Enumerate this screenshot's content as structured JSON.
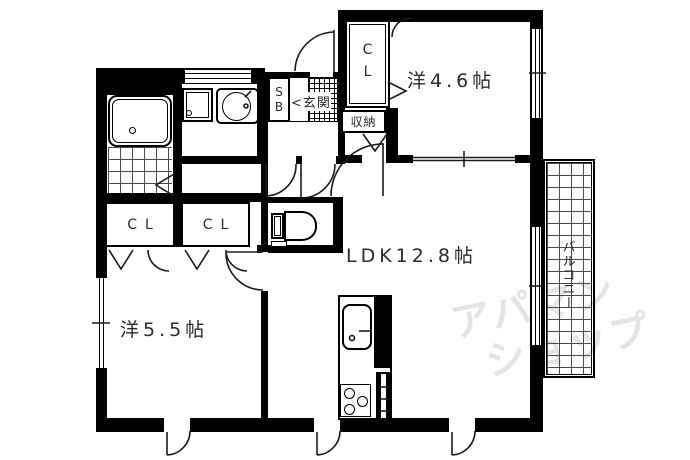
{
  "floorplan": {
    "rooms": {
      "western_46": {
        "label": "洋4.6帖"
      },
      "ldk": {
        "label": "LDK12.8帖"
      },
      "western_55": {
        "label": "洋5.5帖"
      }
    },
    "labels": {
      "closet_north": "CL",
      "closet_west_1": "CL",
      "closet_west_2": "CL",
      "storage": "収納",
      "entrance": "玄関",
      "entrance_arrow": "<",
      "shoe_box": "SB",
      "balcony": "バルコニー"
    },
    "watermark": {
      "line1": "アパマン",
      "line2": "ショップ",
      "color": "#e4e4e4"
    },
    "colors": {
      "wall": "#000000",
      "background": "#ffffff",
      "label_text": "#2b2b2b"
    }
  }
}
